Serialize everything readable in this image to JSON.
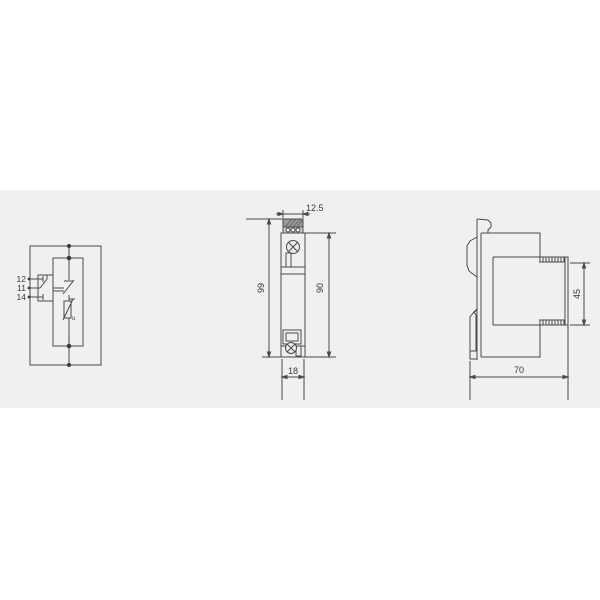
{
  "page": {
    "background": "#ffffff",
    "drawing_band_color": "#f0f0f0",
    "line_color": "#4a4a4a",
    "text_color": "#3a3a3a"
  },
  "views": {
    "circuit": {
      "terminals": [
        "12",
        "11",
        "14"
      ],
      "varistor_label": "u",
      "icons": [
        "changeover-contact-icon",
        "thermal-disconnect-icon",
        "varistor-icon",
        "junction-dot-icon"
      ]
    },
    "front": {
      "dimensions": {
        "terminal_width": "12.5",
        "total_height": "99",
        "body_height": "90",
        "body_width": "18"
      },
      "icons": [
        "screw-icon",
        "terminal-block-icon",
        "label-window-icon"
      ]
    },
    "side": {
      "dimensions": {
        "module_height": "45",
        "depth": "70"
      },
      "icons": [
        "din-rail-clip-icon",
        "plug-module-icon"
      ]
    }
  }
}
